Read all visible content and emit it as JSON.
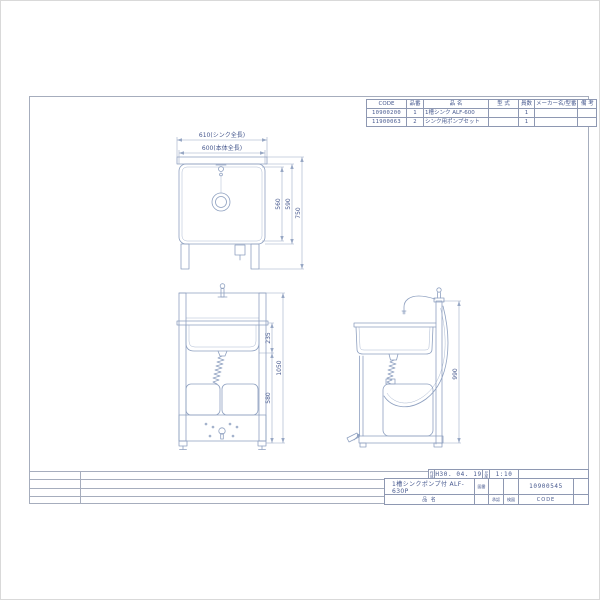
{
  "colors": {
    "line": "#8ea0c0",
    "dim": "#97a7c4",
    "text": "#46588e",
    "frame": "#a6adbd",
    "tline": "#8e98b2"
  },
  "parts_table": {
    "headers": {
      "code": "CODE",
      "item_no": "品番",
      "name": "品  名",
      "model": "型  式",
      "qty": "員数",
      "maker": "メーカー名/型番",
      "remarks": "備  考"
    },
    "rows": [
      {
        "code": "10900200",
        "item_no": "1",
        "name": "1槽シンク ALF-600",
        "model": "",
        "qty": "1",
        "maker": "",
        "remarks": ""
      },
      {
        "code": "11900063",
        "item_no": "2",
        "name": "シンク用ポンプセット",
        "model": "",
        "qty": "1",
        "maker": "",
        "remarks": ""
      }
    ]
  },
  "views": {
    "plan": {
      "dim_sink_length": "610(シンク全長)",
      "dim_body_length": "600(本体全長)",
      "dim_inner_depth": "560",
      "dim_body_depth": "590",
      "dim_total_depth": "750"
    },
    "front": {
      "dim_basin_height": "235",
      "dim_lower_height": "580",
      "dim_total_height": "1050"
    },
    "side": {
      "dim_height": "990"
    }
  },
  "title_block": {
    "date_label": "作成",
    "date": "H30. 04. 19",
    "scale_label": "尺度",
    "scale": "1:10",
    "name": "1槽シンクポンプ付 ALF-630P",
    "name_label": "品  名",
    "drawing_label": "図番",
    "approved_label": "承認",
    "checked_label": "検図",
    "code": "10900545",
    "code_label": "CODE"
  }
}
